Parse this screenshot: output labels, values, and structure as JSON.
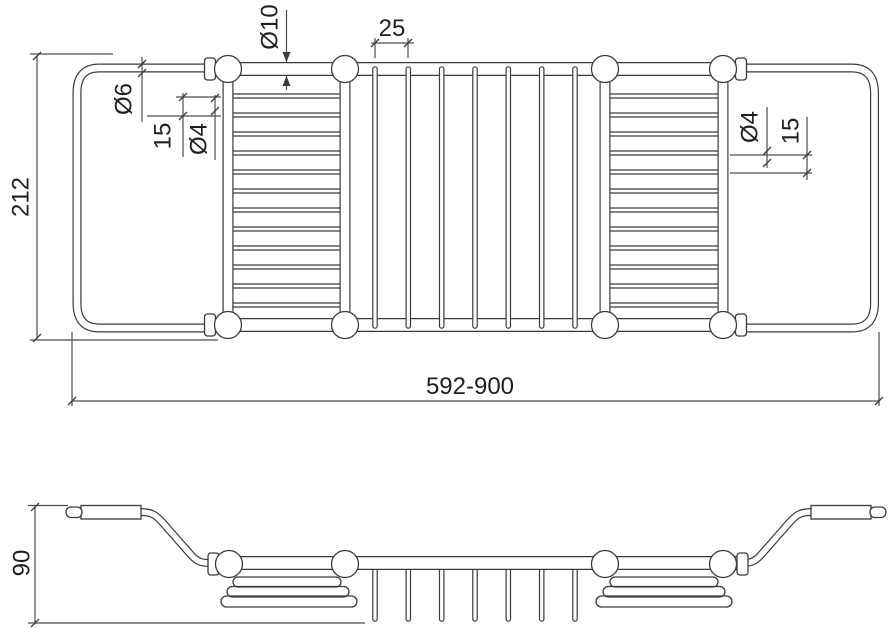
{
  "meta": {
    "drawing_type": "technical dimension drawing, plan view and side view",
    "background_color": "#ffffff",
    "line_color": "#3a3a3a",
    "dimension_line_color": "#4d4d4d",
    "text_color": "#1f1f1f"
  },
  "plan_view": {
    "labels": {
      "overall_depth": "212",
      "length_range": "592-900",
      "rail_diameter": "Ø10",
      "mid_wire_spacing": "25",
      "handle_tube_diameter": "Ø6",
      "left_wire_spacing": "15",
      "left_wire_diameter": "Ø4",
      "right_wire_diameter": "Ø4",
      "right_wire_spacing": "15"
    }
  },
  "side_view": {
    "labels": {
      "height": "90"
    }
  }
}
